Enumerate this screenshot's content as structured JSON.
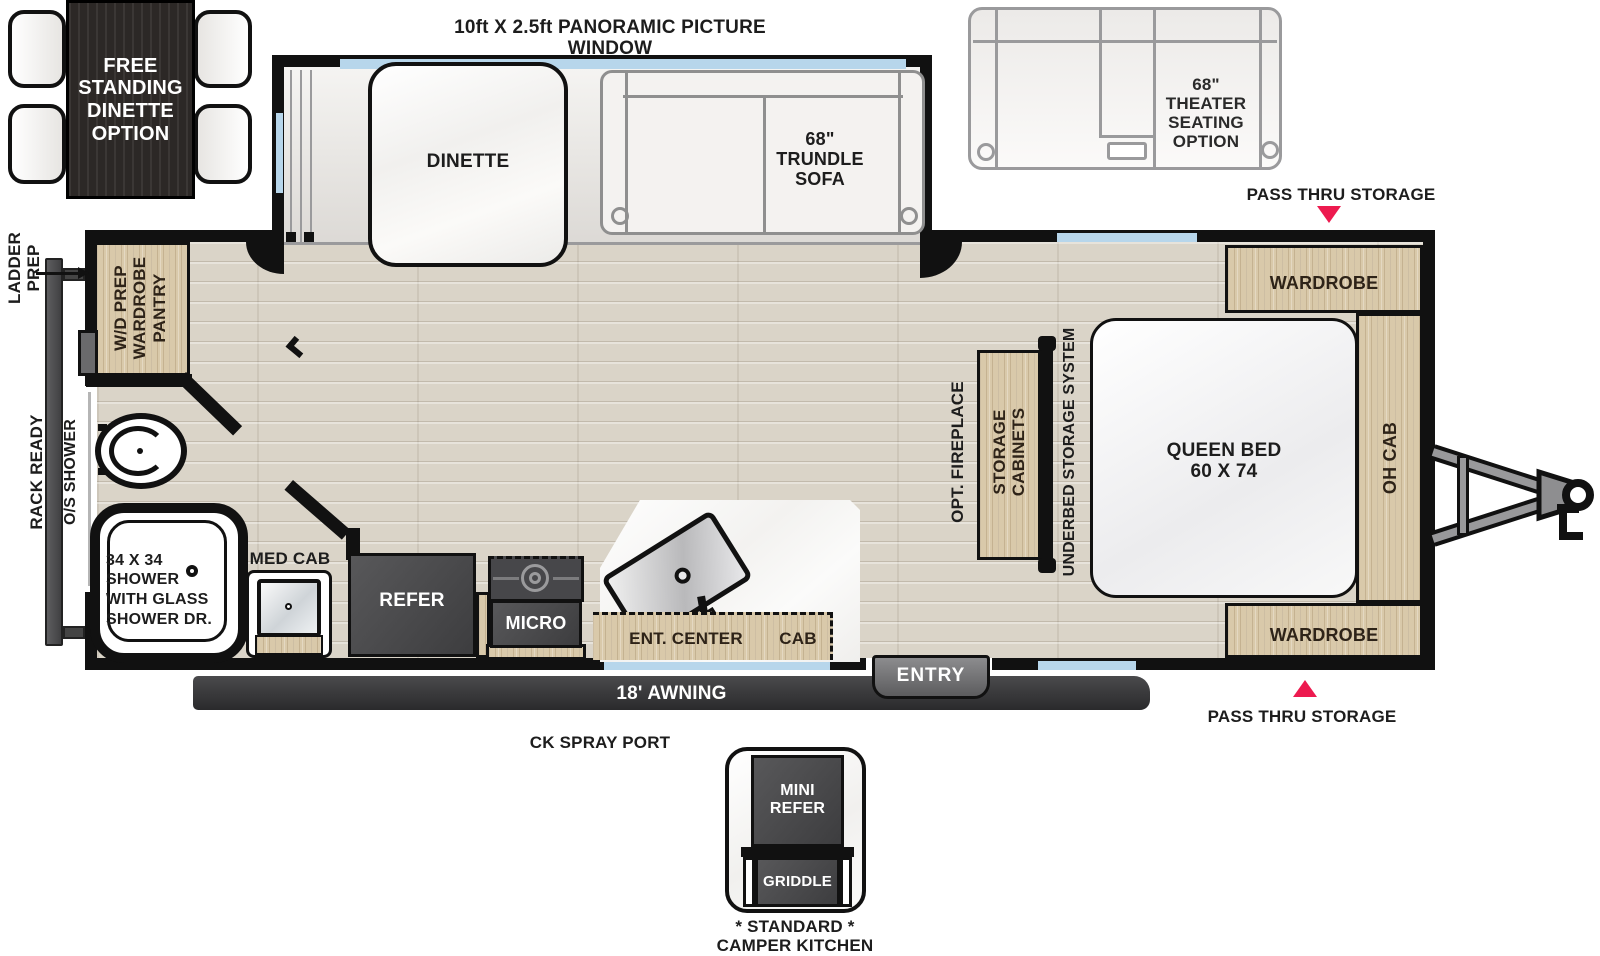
{
  "colors": {
    "wall": "#111111",
    "accent_red": "#ed1a4f",
    "window_blue": "#b7d6eb",
    "wood": "#d9c9aa",
    "dark_appliance": "#4a4a4c"
  },
  "callouts": {
    "panoramic_window": "10ft X 2.5ft PANORAMIC PICTURE WINDOW",
    "pass_thru_top": "PASS THRU STORAGE",
    "pass_thru_bottom": "PASS THRU STORAGE",
    "ladder_prep": "LADDER\nPREP",
    "rack_ready": "RACK READY",
    "os_shower": "O/S SHOWER",
    "awning": "18' AWNING",
    "ck_spray_port": "CK SPRAY PORT",
    "entry": "ENTRY"
  },
  "options": {
    "free_dinette": "FREE\nSTANDING\nDINETTE\nOPTION",
    "theater_seating": "68\"\nTHEATER\nSEATING\nOPTION",
    "camper_kitchen": {
      "mini_refer": "MINI\nREFER",
      "griddle": "GRIDDLE",
      "standard": "* STANDARD *\nCAMPER KITCHEN"
    }
  },
  "slide": {
    "dinette": "DINETTE",
    "trundle_sofa": "68\"\nTRUNDLE\nSOFA"
  },
  "bedroom": {
    "wardrobe_top": "WARDROBE",
    "wardrobe_bottom": "WARDROBE",
    "oh_cab": "OH CAB",
    "queen_bed": "QUEEN BED\n60 X 74",
    "underbed": "UNDERBED STORAGE SYSTEM",
    "storage_cabinets": "STORAGE\nCABINETS",
    "opt_fireplace": "OPT. FIREPLACE"
  },
  "bath": {
    "wd_pantry": "W/D PREP\nWARDROBE\nPANTRY",
    "shower": "34 X 34\nSHOWER\nWITH GLASS\nSHOWER DR.",
    "med_cab": "MED CAB"
  },
  "kitchen": {
    "refer": "REFER",
    "micro": "MICRO",
    "ent_center": "ENT. CENTER",
    "cab": "CAB"
  }
}
